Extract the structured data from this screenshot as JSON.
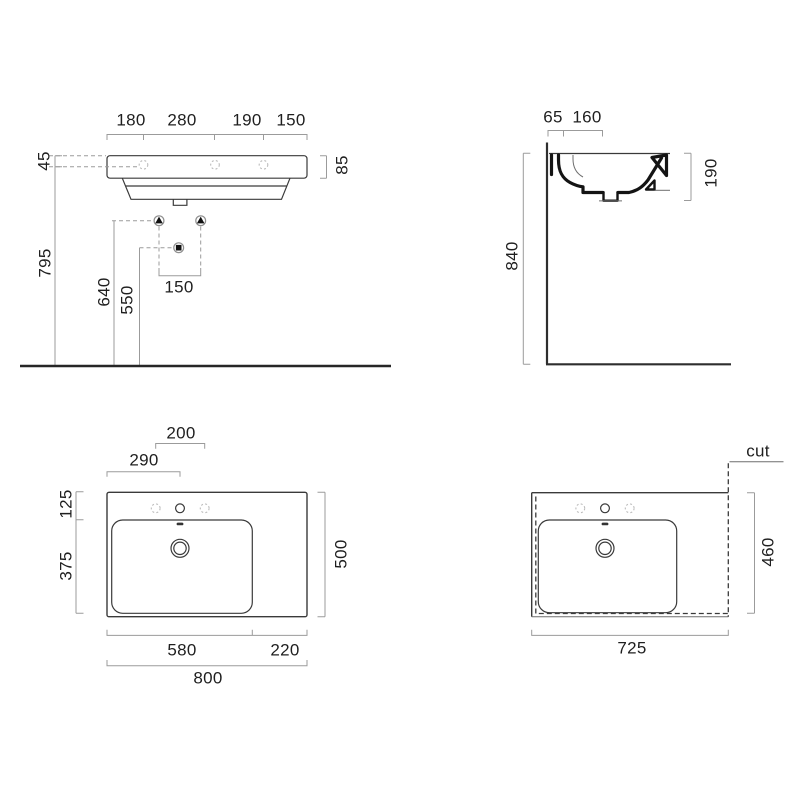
{
  "drawing": {
    "type": "technical-dimension-drawing",
    "subject": "wall-hung washbasin, 4 views",
    "line_color": "#3a3a3a",
    "dim_color": "#9b9b9b",
    "text_color": "#1f1f1f",
    "background": "#ffffff"
  },
  "front_view": {
    "dim_180": "180",
    "dim_280": "280",
    "dim_190": "190",
    "dim_150_top": "150",
    "dim_45": "45",
    "dim_795": "795",
    "dim_640": "640",
    "dim_550": "550",
    "dim_150_fixing": "150",
    "dim_85": "85"
  },
  "side_view": {
    "dim_65": "65",
    "dim_160": "160",
    "dim_840": "840",
    "dim_190": "190"
  },
  "plan_view": {
    "dim_200": "200",
    "dim_290": "290",
    "dim_125": "125",
    "dim_375": "375",
    "dim_500": "500",
    "dim_580": "580",
    "dim_220": "220",
    "dim_800": "800"
  },
  "cut_view": {
    "cut_label": "cut",
    "dim_725": "725",
    "dim_460": "460"
  }
}
